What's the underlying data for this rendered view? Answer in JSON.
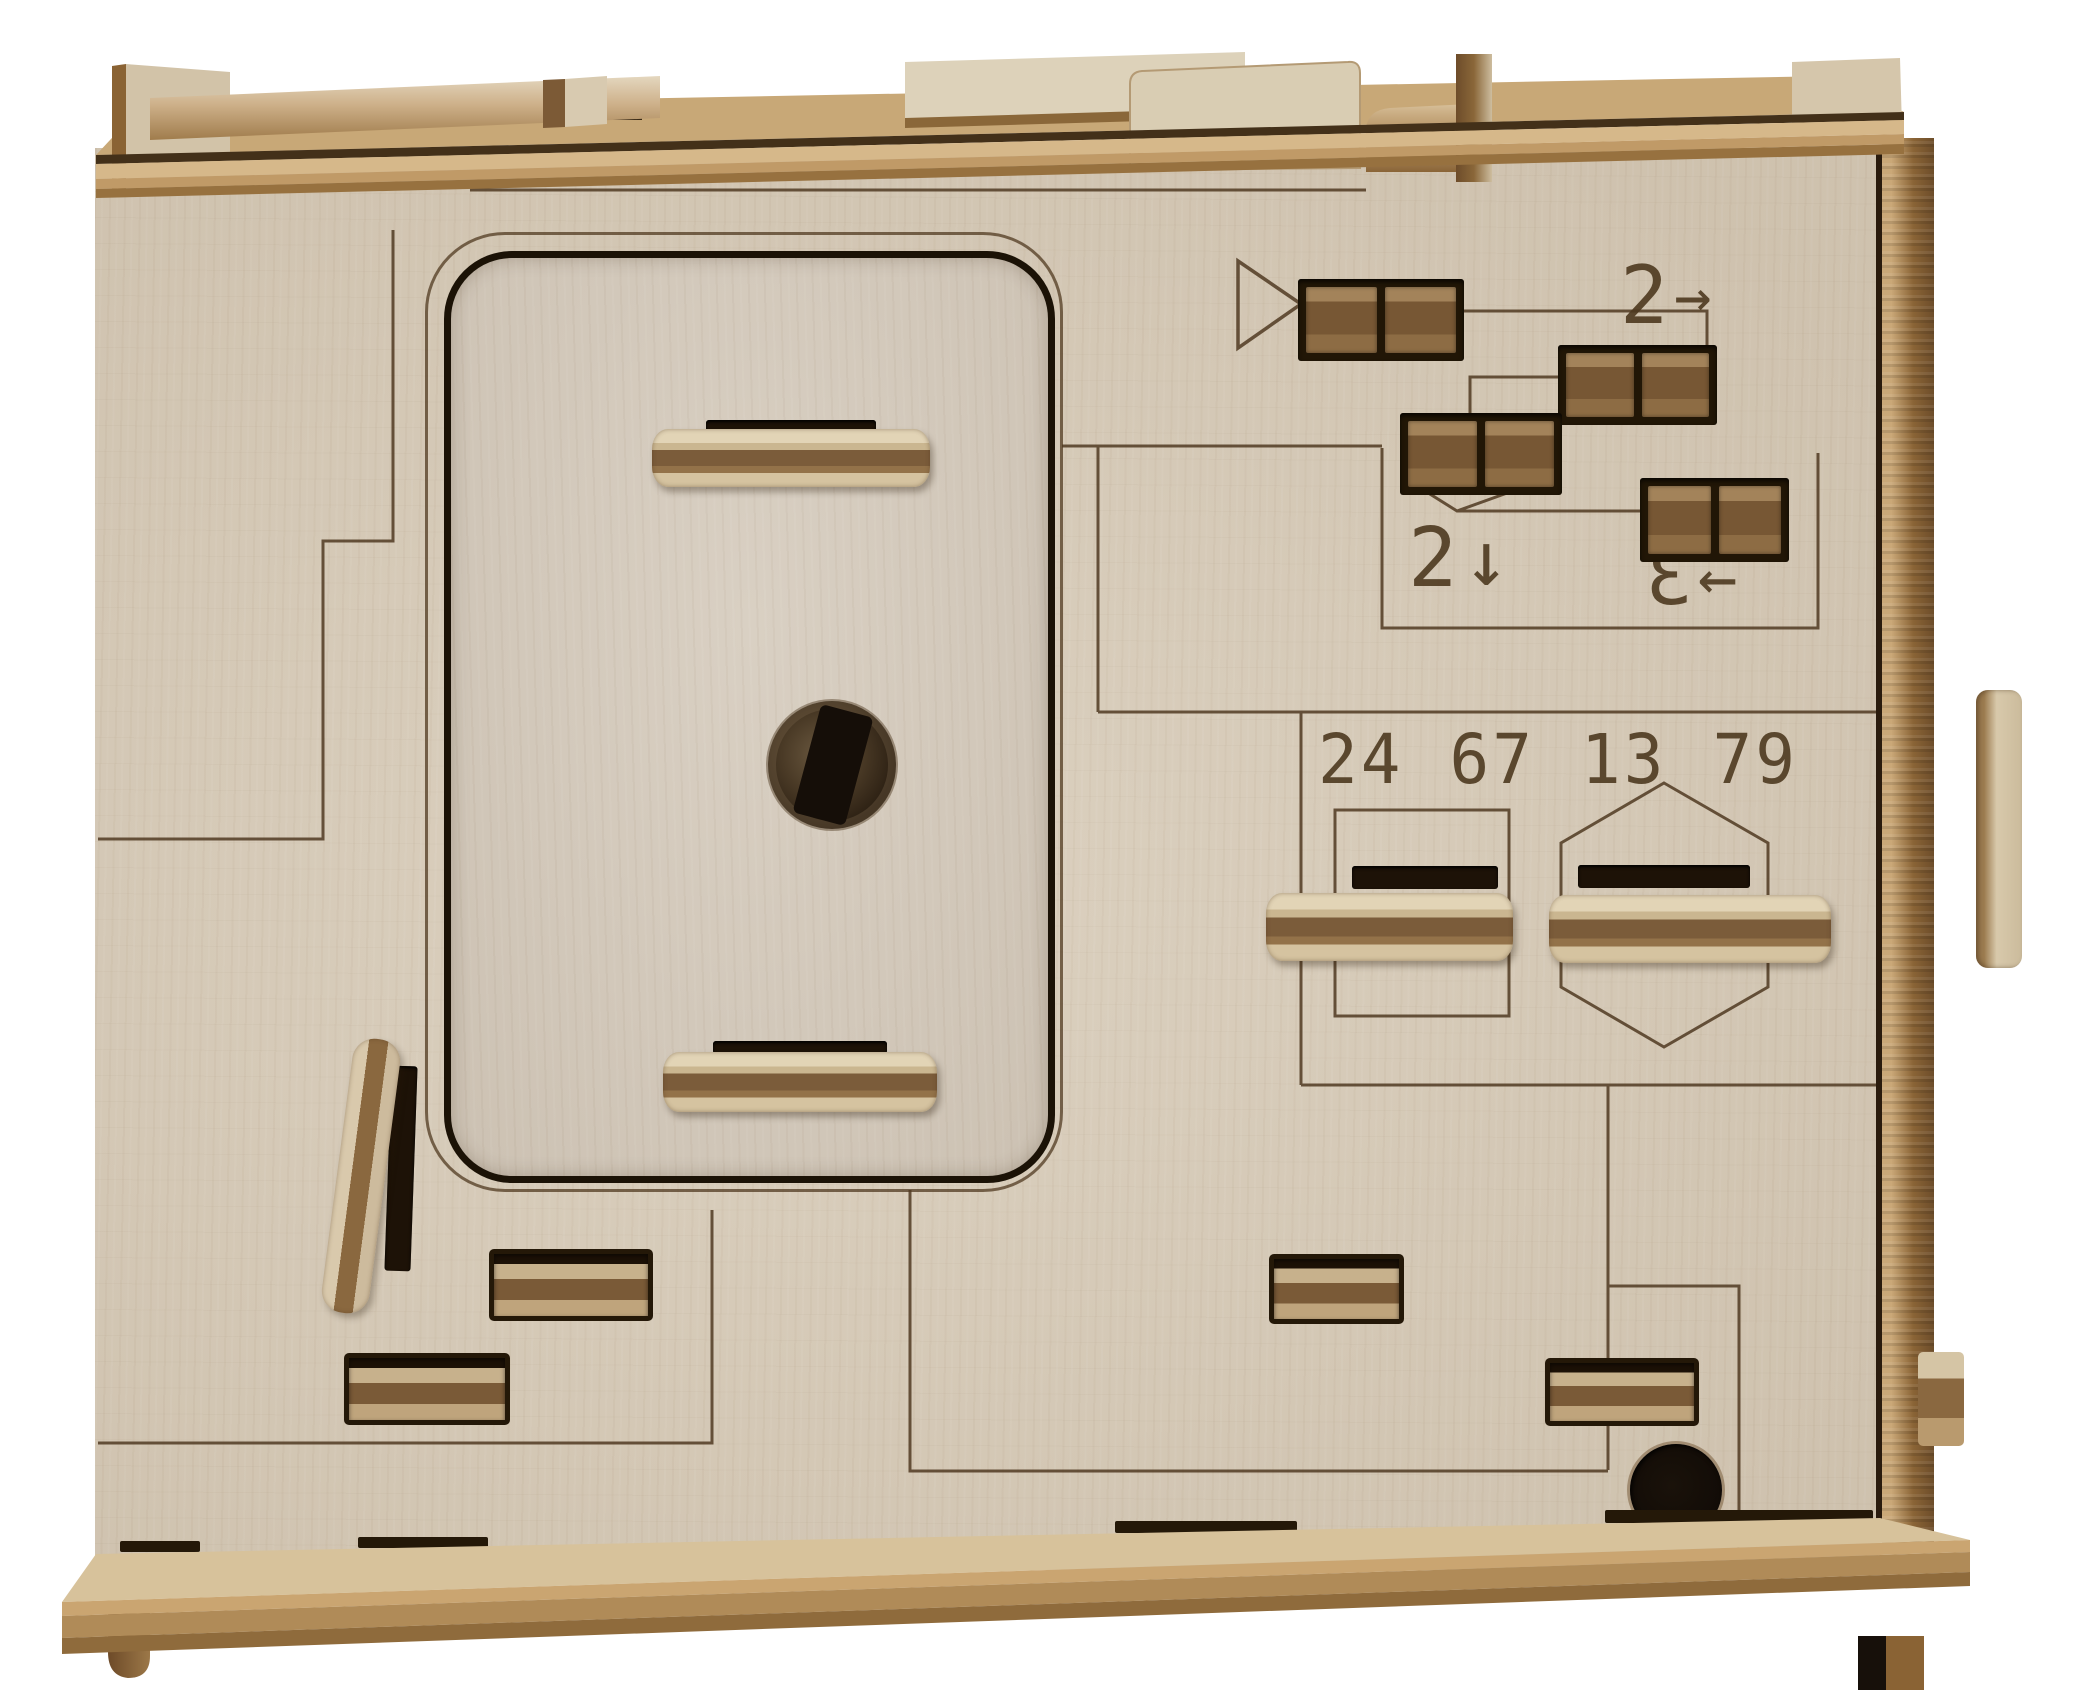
{
  "scene": {
    "object": "Laser-cut wooden mechanical puzzle box, front view",
    "background": "#ffffff"
  },
  "palette": {
    "face_wood": "#d8ccb9",
    "edge_wood_light": "#c9a877",
    "edge_wood_dark": "#8f6b3c",
    "engraving": "#4f3a20",
    "slot_dark": "#241808",
    "slider_light": "#d3c2a4",
    "slider_dark": "#76583a"
  },
  "engravings": {
    "play_symbol": "▷",
    "step_right_digit": "2",
    "step_right_arrow": "→",
    "step_down_digit": "2",
    "step_down_arrow": "↓",
    "step_left_digit": "3",
    "step_left_arrow": "←",
    "code_groups": [
      "24",
      "67",
      "13",
      "79"
    ]
  }
}
